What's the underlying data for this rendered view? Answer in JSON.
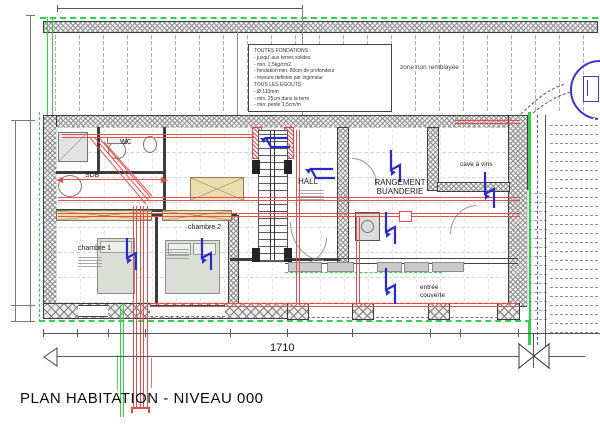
{
  "title": "PLAN HABITATION - NIVEAU 000",
  "notes_box": {
    "lines": [
      "TOUTES FONDATIONS :",
      "- jusqu' aux terres solides",
      "- min. 2,5kg/cm2",
      "- fondation min. 80cm de profondeur",
      "- mesure definies par ingenieur",
      "TOUS LES EGOUTS :",
      "- Ø 110mm",
      "- min. 25cm dans la terre",
      "- min. pente 1,5cm/m"
    ]
  },
  "annotations": {
    "zone": "zone non remblayée",
    "dimension_total": "1710"
  },
  "rooms": {
    "wc": "WC",
    "sdb": "SDB",
    "chambre1": "chambre 1",
    "chambre2": "chambre 2",
    "hall": "HALL",
    "rangement_line1": "RANGEMENT",
    "rangement_line2": "BUANDERIE",
    "cave": "cave à vins",
    "entree_line1": "entrée",
    "entree_line2": "couverte"
  },
  "colors": {
    "drain_green": "#2fd24a",
    "pipe_red": "#e05050",
    "annotation_blue": "#2a2ac8",
    "wall_gray": "#909090",
    "furniture_tan": "#ecdcae",
    "bed_gray": "#d9ded6"
  }
}
